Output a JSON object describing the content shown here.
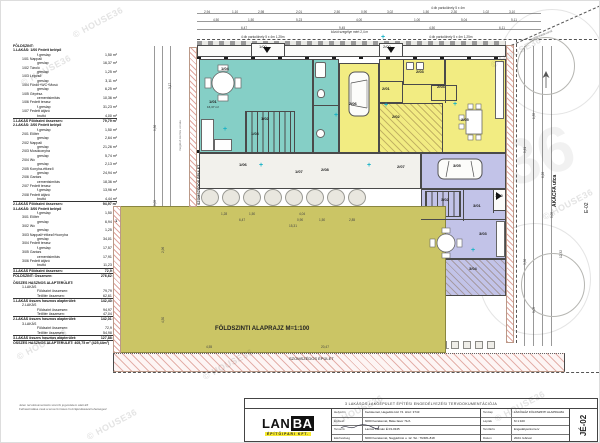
{
  "watermark": {
    "text": "© HOUSE36",
    "ghost": "36"
  },
  "schedule": {
    "lines": [
      {
        "t": "h",
        "l": "FÖLDSZINT:"
      },
      {
        "t": "h2",
        "l": "1.LAKÁS: 1/00 Fedett belépő"
      },
      {
        "t": "v",
        "l": "f.greslap",
        "v": "1,50 m²"
      },
      {
        "t": "i",
        "l": "1/01 Nappali"
      },
      {
        "t": "v",
        "l": "greslap",
        "v": "16,37 m²"
      },
      {
        "t": "i",
        "l": "1/02 Tároló"
      },
      {
        "t": "v",
        "l": "greslap",
        "v": "1,25 m²"
      },
      {
        "t": "i",
        "l": "1/03 Lépcső"
      },
      {
        "t": "v",
        "l": "greslap",
        "v": "3,11 m²"
      },
      {
        "t": "i",
        "l": "1/04 Fürdő+WC+Mosó"
      },
      {
        "t": "v",
        "l": "greslap",
        "v": "6,25 m²"
      },
      {
        "t": "i",
        "l": "1/05 Gépész."
      },
      {
        "t": "v",
        "l": "cementsimítás",
        "v": "10,36 m²"
      },
      {
        "t": "i",
        "l": "1/06 Fedett terasz"
      },
      {
        "t": "v",
        "l": "f.greslap",
        "v": "31,23 m²"
      },
      {
        "t": "i",
        "l": "1/07 Fedett átjáró"
      },
      {
        "t": "v",
        "l": "bruttó",
        "v": "4,00 m²"
      },
      {
        "t": "t",
        "l": "1.LAKÁS Földszint összesen:",
        "v": "79,79 m²"
      },
      {
        "t": "h2",
        "l": "2.LAKÁS: 2/00 Fedett belépő"
      },
      {
        "t": "v",
        "l": "f.greslap",
        "v": "1,50 m²"
      },
      {
        "t": "i",
        "l": "2/01 Előtér"
      },
      {
        "t": "v",
        "l": "greslap",
        "v": "2,64 m²"
      },
      {
        "t": "i",
        "l": "2/02 Nappali"
      },
      {
        "t": "v",
        "l": "greslap",
        "v": "21,26 m²"
      },
      {
        "t": "i",
        "l": "2/03 Mosókonyha"
      },
      {
        "t": "v",
        "l": "greslap",
        "v": "5,74 m²"
      },
      {
        "t": "i",
        "l": "2/04 Wc"
      },
      {
        "t": "v",
        "l": "greslap",
        "v": "2,13 m²"
      },
      {
        "t": "i",
        "l": "2/05 Konyha-étkező"
      },
      {
        "t": "v",
        "l": "greslap",
        "v": "24,94 m²"
      },
      {
        "t": "i",
        "l": "2/06 Garázs"
      },
      {
        "t": "v",
        "l": "cementsimítás",
        "v": "18,36 m²"
      },
      {
        "t": "i",
        "l": "2/07 Fedett terasz"
      },
      {
        "t": "v",
        "l": "f.greslap",
        "v": "13,96 m²"
      },
      {
        "t": "i",
        "l": "2/08 Fedett átjáró"
      },
      {
        "t": "v",
        "l": "bruttó",
        "v": "4,44 m²"
      },
      {
        "t": "t",
        "l": "2.LAKÁS Földszint összesen:",
        "v": "94,97 m²"
      },
      {
        "t": "h2",
        "l": "3.LAKÁS: 3/00 Fedett belépő"
      },
      {
        "t": "v",
        "l": "f.greslap",
        "v": "1,50 m²"
      },
      {
        "t": "i",
        "l": "3/01 Előtér"
      },
      {
        "t": "v",
        "l": "greslap",
        "v": "6,94 m²"
      },
      {
        "t": "i",
        "l": "3/02 Wc"
      },
      {
        "t": "v",
        "l": "greslap",
        "v": "1,25 m²"
      },
      {
        "t": "i",
        "l": "3/03 Nappali+étkező+konyha"
      },
      {
        "t": "v",
        "l": "greslap",
        "v": "34,01 m²"
      },
      {
        "t": "i",
        "l": "3/04 Fedett terasz"
      },
      {
        "t": "v",
        "l": "f.greslap",
        "v": "17,57 m²"
      },
      {
        "t": "i",
        "l": "3/05 Garázs"
      },
      {
        "t": "v",
        "l": "cementsimítás",
        "v": "17,91 m²"
      },
      {
        "t": "i",
        "l": "3/06 Fedett átjáró"
      },
      {
        "t": "v",
        "l": "bruttó",
        "v": "11,23 m²"
      },
      {
        "t": "t",
        "l": "3.LAKÁS Földszint összesen:",
        "v": "72,9 m²"
      },
      {
        "t": "t",
        "l": "FÖLDSZINT: Összesen:",
        "v": "276,62 m²"
      },
      {
        "t": "g",
        "l": ""
      },
      {
        "t": "h",
        "l": "ÖSSZES HASZNOS ALAPTERÜLET:"
      },
      {
        "t": "i",
        "l": "1.LAKÁS"
      },
      {
        "t": "v",
        "l": "Földszint összesen:",
        "v": "79,79 m²"
      },
      {
        "t": "v",
        "l": "Tetőtér összesen:",
        "v": "62,61 m²"
      },
      {
        "t": "t",
        "l": "1.LAKÁS összes hasznos alapterület:",
        "v": "142,40 m²"
      },
      {
        "t": "i",
        "l": "2.LAKÁS"
      },
      {
        "t": "v",
        "l": "Földszint összesen:",
        "v": "94,97 m²"
      },
      {
        "t": "v",
        "l": "Tetőtér összesen:",
        "v": "47,04 m²"
      },
      {
        "t": "t",
        "l": "2.LAKÁS összes hasznos alapterület:",
        "v": "142,01 m²"
      },
      {
        "t": "i",
        "l": "3.LAKÁS"
      },
      {
        "t": "v",
        "l": "Földszint összesen:",
        "v": "72,9 m²"
      },
      {
        "t": "v",
        "l": "Tetőtér összesen:",
        "v": "54,98 m²"
      },
      {
        "t": "t",
        "l": "3.LAKÁS összes hasznos alapterület:",
        "v": "127,88 m²"
      },
      {
        "t": "t",
        "l": "ÖSSZES HASZNOS ALAPTERÜLET: 405,75 m² (425,44m²)"
      }
    ]
  },
  "plan": {
    "rooms": [
      {
        "n": "pavement-top",
        "x": 196,
        "y": 44,
        "w": 309,
        "h": 12,
        "c": "white"
      },
      {
        "n": "porch-1-00",
        "x": 250,
        "y": 42,
        "w": 34,
        "h": 14,
        "c": "white"
      },
      {
        "n": "porch-2-00",
        "x": 378,
        "y": 42,
        "w": 24,
        "h": 14,
        "c": "white"
      },
      {
        "n": "unit1-main",
        "x": 198,
        "y": 58,
        "w": 114,
        "h": 94,
        "c": "teal"
      },
      {
        "n": "unit1-strip",
        "x": 312,
        "y": 58,
        "w": 26,
        "h": 94,
        "c": "teal"
      },
      {
        "n": "unit1-stairs",
        "x": 244,
        "y": 110,
        "w": 50,
        "h": 42,
        "c": "teal stairsH"
      },
      {
        "n": "garage-2-06",
        "x": 338,
        "y": 62,
        "w": 40,
        "h": 90,
        "c": "yellow"
      },
      {
        "n": "unit2-block",
        "x": 378,
        "y": 58,
        "w": 127,
        "h": 94,
        "c": "yellow"
      },
      {
        "n": "room-2-03",
        "x": 402,
        "y": 58,
        "w": 42,
        "h": 26,
        "c": "yellow"
      },
      {
        "n": "room-2-01",
        "x": 378,
        "y": 80,
        "w": 24,
        "h": 22,
        "c": "yellow"
      },
      {
        "n": "room-2-04",
        "x": 430,
        "y": 84,
        "w": 26,
        "h": 16,
        "c": "yellow"
      },
      {
        "n": "room-2-02",
        "x": 378,
        "y": 102,
        "w": 64,
        "h": 50,
        "c": "yellow hatch"
      },
      {
        "n": "terrace-band",
        "x": 198,
        "y": 152,
        "w": 222,
        "h": 36,
        "c": "band"
      },
      {
        "n": "garage-3-05",
        "x": 420,
        "y": 152,
        "w": 85,
        "h": 36,
        "c": "purple"
      },
      {
        "n": "unit3-block",
        "x": 420,
        "y": 188,
        "w": 85,
        "h": 70,
        "c": "purple"
      },
      {
        "n": "unit3-stairs",
        "x": 424,
        "y": 190,
        "w": 36,
        "h": 26,
        "c": "purple stairsH"
      },
      {
        "n": "porch-3-00",
        "x": 492,
        "y": 188,
        "w": 13,
        "h": 22,
        "c": "white"
      },
      {
        "n": "terrace-3-04",
        "x": 420,
        "y": 258,
        "w": 85,
        "h": 37,
        "c": "purple hatch"
      },
      {
        "n": "garden",
        "x": 118,
        "y": 205,
        "w": 327,
        "h": 147,
        "c": "olive"
      },
      {
        "n": "boundary-left-wall",
        "x": 188,
        "y": 46,
        "w": 8,
        "h": 160,
        "c": "rhatch"
      },
      {
        "n": "boundary-garden-left",
        "x": 112,
        "y": 205,
        "w": 8,
        "h": 147,
        "c": "rhatch"
      },
      {
        "n": "fence-right",
        "x": 505,
        "y": 44,
        "w": 8,
        "h": 298,
        "c": "rhatch"
      },
      {
        "n": "neighbor-bottom-strip",
        "x": 112,
        "y": 352,
        "w": 452,
        "h": 19,
        "c": "rhatch2"
      }
    ],
    "walls": [
      {
        "x": 462,
        "y": 188,
        "w": 1,
        "h": 32
      },
      {
        "x": 492,
        "y": 188,
        "w": 1,
        "h": 24
      },
      {
        "x": 420,
        "y": 218,
        "w": 85,
        "h": 1
      },
      {
        "x": 444,
        "y": 58,
        "w": 1,
        "h": 44
      },
      {
        "x": 312,
        "y": 104,
        "w": 26,
        "h": 1
      }
    ],
    "labels": [
      {
        "t": "1/00",
        "x": 258,
        "y": 44
      },
      {
        "t": "1/04",
        "x": 220,
        "y": 66,
        "b": 1
      },
      {
        "t": "1/01",
        "x": 208,
        "y": 99,
        "b": 1
      },
      {
        "t": "16,37 m²",
        "x": 206,
        "y": 105,
        "s": 3
      },
      {
        "t": "1/02",
        "x": 260,
        "y": 116,
        "b": 1
      },
      {
        "t": "1/03",
        "x": 250,
        "y": 131,
        "b": 1
      },
      {
        "t": "2/06",
        "x": 348,
        "y": 101,
        "b": 1
      },
      {
        "t": "2/00",
        "x": 382,
        "y": 44
      },
      {
        "t": "2/01",
        "x": 381,
        "y": 86,
        "b": 1
      },
      {
        "t": "2/02",
        "x": 391,
        "y": 114,
        "b": 1
      },
      {
        "t": "2/03",
        "x": 415,
        "y": 69,
        "b": 1
      },
      {
        "t": "2/04",
        "x": 436,
        "y": 84,
        "b": 1
      },
      {
        "t": "2/05",
        "x": 460,
        "y": 117,
        "b": 1
      },
      {
        "t": "3/05",
        "x": 452,
        "y": 163,
        "b": 1
      },
      {
        "t": "2/07",
        "x": 396,
        "y": 164,
        "b": 1
      },
      {
        "t": "1/06",
        "x": 238,
        "y": 162,
        "b": 1
      },
      {
        "t": "1/07",
        "x": 294,
        "y": 169,
        "b": 1
      },
      {
        "t": "2/08",
        "x": 320,
        "y": 167,
        "b": 1
      },
      {
        "t": "3/02",
        "x": 440,
        "y": 197,
        "b": 1
      },
      {
        "t": "3/01",
        "x": 472,
        "y": 203,
        "b": 1
      },
      {
        "t": "3/00",
        "x": 494,
        "y": 193
      },
      {
        "t": "3/03",
        "x": 478,
        "y": 231,
        "b": 1
      },
      {
        "t": "3/04",
        "x": 468,
        "y": 266,
        "b": 1
      },
      {
        "t": "FÖLDSZINTI ALAPRAJZ M=1:100",
        "x": 214,
        "y": 325,
        "b": 1,
        "s": 6,
        "n": "plan-title"
      },
      {
        "t": "SZOMSZÉDOS ÉPÜLET",
        "x": 288,
        "y": 356,
        "s": 4,
        "n": "neighbor-bottom-label"
      },
      {
        "t": "SZOMSZÉDOS ÉPÜLET",
        "x": 197,
        "y": 204,
        "s": 3.6,
        "r": -90,
        "b": 1,
        "n": "neighbor-left-label"
      },
      {
        "t": "AKÁCFA utca",
        "x": 552,
        "y": 206,
        "s": 5,
        "r": -90,
        "b": 1,
        "n": "street-label"
      },
      {
        "t": "E-02",
        "x": 584,
        "y": 212,
        "s": 5,
        "r": -90,
        "n": "sheet-edge-number"
      },
      {
        "t": "ingatlanhatárvonal",
        "x": 528,
        "y": 38,
        "s": 3,
        "r": -22,
        "col": "#777"
      },
      {
        "t": "meglévő kerítés vonala",
        "x": 178,
        "y": 150,
        "s": 3,
        "r": -90,
        "col": "#777"
      },
      {
        "t": "4 db parkolóhely 5 x 4m 1,25m",
        "x": 240,
        "y": 35,
        "s": 3.2,
        "col": "#333"
      },
      {
        "t": "közút szegélye mért 2,4 m",
        "x": 330,
        "y": 30,
        "s": 3.2,
        "col": "#333"
      },
      {
        "t": "4 db parkolóhely 5 x 4m 1,25m",
        "x": 428,
        "y": 35,
        "s": 3.2,
        "col": "#333"
      },
      {
        "t": "4 db parkolóhely 5 x 4m",
        "x": 430,
        "y": 6,
        "s": 3.2,
        "col": "#333"
      },
      {
        "t": "1",
        "x": 114,
        "y": 218,
        "b": 1,
        "s": 4,
        "n": "section-marker"
      }
    ],
    "dims": [
      {
        "t": "2,94",
        "x": 203,
        "y": 9
      },
      {
        "t": "1,10",
        "x": 231,
        "y": 9
      },
      {
        "t": "2,98",
        "x": 257,
        "y": 9
      },
      {
        "t": "2,01",
        "x": 295,
        "y": 9
      },
      {
        "t": "2,50",
        "x": 333,
        "y": 9
      },
      {
        "t": "0,90",
        "x": 360,
        "y": 9
      },
      {
        "t": "3,02",
        "x": 386,
        "y": 9
      },
      {
        "t": "1,50",
        "x": 422,
        "y": 9
      },
      {
        "t": "2,30",
        "x": 450,
        "y": 9
      },
      {
        "t": "1,02",
        "x": 482,
        "y": 9
      },
      {
        "t": "3,10",
        "x": 508,
        "y": 9
      },
      {
        "t": "4,50",
        "x": 212,
        "y": 17
      },
      {
        "t": "1,50",
        "x": 247,
        "y": 17
      },
      {
        "t": "5,23",
        "x": 295,
        "y": 17
      },
      {
        "t": "4,00",
        "x": 355,
        "y": 17
      },
      {
        "t": "1,00",
        "x": 413,
        "y": 17
      },
      {
        "t": "5,04",
        "x": 460,
        "y": 17
      },
      {
        "t": "5,11",
        "x": 510,
        "y": 17
      },
      {
        "t": "6,47",
        "x": 240,
        "y": 25
      },
      {
        "t": "9,45",
        "x": 338,
        "y": 25
      },
      {
        "t": "4,50",
        "x": 428,
        "y": 25
      },
      {
        "t": "6,11",
        "x": 498,
        "y": 25
      },
      {
        "t": "1,28",
        "x": 220,
        "y": 211
      },
      {
        "t": "1,50",
        "x": 248,
        "y": 211
      },
      {
        "t": "4,04",
        "x": 298,
        "y": 211
      },
      {
        "t": "6,47",
        "x": 238,
        "y": 217
      },
      {
        "t": "0,90",
        "x": 296,
        "y": 217
      },
      {
        "t": "1,50",
        "x": 318,
        "y": 217
      },
      {
        "t": "2,85",
        "x": 348,
        "y": 217
      },
      {
        "t": "15,31",
        "x": 288,
        "y": 223
      },
      {
        "t": "4,55",
        "x": 205,
        "y": 344
      },
      {
        "t": "20,47",
        "x": 320,
        "y": 344
      },
      {
        "t": "3,17",
        "x": 167,
        "y": 88,
        "v": 1
      },
      {
        "t": "9,36",
        "x": 152,
        "y": 130,
        "v": 1
      },
      {
        "t": "5,05",
        "x": 152,
        "y": 205,
        "v": 1
      },
      {
        "t": "2,96",
        "x": 160,
        "y": 252,
        "v": 1
      },
      {
        "t": "4,50",
        "x": 160,
        "y": 322,
        "v": 1
      },
      {
        "t": "1,35",
        "x": 531,
        "y": 118,
        "v": 1
      },
      {
        "t": "5,61",
        "x": 522,
        "y": 152,
        "v": 1
      },
      {
        "t": "6,28",
        "x": 540,
        "y": 177,
        "v": 1
      },
      {
        "t": "5,05",
        "x": 549,
        "y": 217,
        "v": 1
      },
      {
        "t": "3,36",
        "x": 522,
        "y": 264,
        "v": 1
      },
      {
        "t": "12,32",
        "x": 558,
        "y": 257,
        "v": 1
      },
      {
        "t": "5,05",
        "x": 531,
        "y": 312,
        "v": 1
      }
    ],
    "crosses": [
      {
        "x": 222,
        "y": 126
      },
      {
        "x": 258,
        "y": 162
      },
      {
        "x": 366,
        "y": 162
      },
      {
        "x": 383,
        "y": 102
      },
      {
        "x": 452,
        "y": 101
      },
      {
        "x": 470,
        "y": 247
      },
      {
        "x": 333,
        "y": 112
      },
      {
        "x": 380,
        "y": 34
      }
    ],
    "watermarks": [
      {
        "x": 18,
        "y": 78
      },
      {
        "x": 70,
        "y": 30
      },
      {
        "x": 488,
        "y": 60
      },
      {
        "x": 540,
        "y": 212
      },
      {
        "x": 14,
        "y": 352
      },
      {
        "x": 84,
        "y": 432
      },
      {
        "x": 330,
        "y": 418
      },
      {
        "x": 200,
        "y": 372
      },
      {
        "x": 492,
        "y": 414
      }
    ]
  },
  "titleblock": {
    "project": "3 LAKÁSOS LAKÓÉPÜLET ÉPÍTÉSI ENGEDÉLYEZÉSI TERVDOKUMENTÁCIÓJA",
    "logo": {
      "part1": "LAN",
      "part2": "BA",
      "subtitle": "ÉPÍTŐIPARI KFT."
    },
    "rows_left": [
      {
        "label": "Helyszín",
        "value": "Kecskemét, Hegedűs köz 74.  Hrsz: 3743"
      },
      {
        "label": "Építtető",
        "value": "6000 Kecskemét, Béke fasor 71/A"
      },
      {
        "label": "Tervező",
        "value": "Lantos Kálmán   É 03-0345"
      },
      {
        "label": "Elérhetőség",
        "value": "6000 Kecskemét, Nagykőrösi u. 12.  Tel.: 76/481-818"
      }
    ],
    "rows_right": [
      {
        "label": "Tervlap",
        "value": "LAKÓHÁZ FÖLDSZINTI ALAPRAJZA"
      },
      {
        "label": "Lépték",
        "value": "M 1:100"
      },
      {
        "label": "Tervfázis",
        "value": "Engedélyezési terv"
      },
      {
        "label": "Dátum",
        "value": "2024. február"
      }
    ],
    "sheet_no": "JÉ-02",
    "copyright": [
      "Jelen tervdokumentáció szerzői jogvédelem alatt áll!",
      "Felhasználása csak a tervező írásos hozzájárulásával lehetséges!"
    ]
  }
}
